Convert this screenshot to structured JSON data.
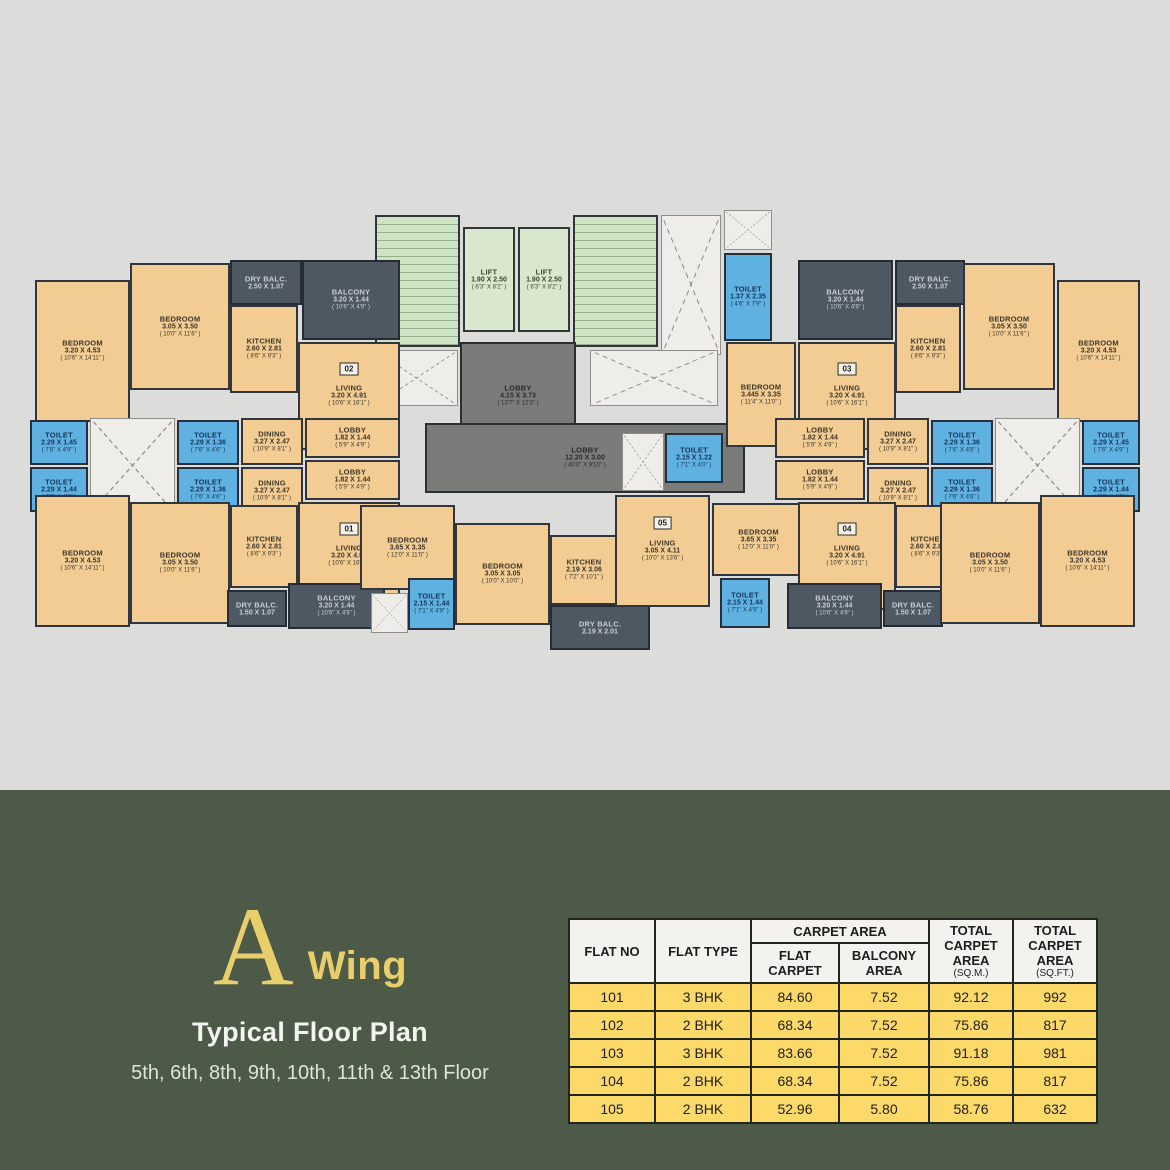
{
  "title": {
    "letter": "A",
    "word": "Wing",
    "subtitle": "Typical Floor Plan",
    "floors": "5th, 6th, 8th, 9th, 10th, 11th & 13th Floor"
  },
  "colors": {
    "gold": "#e8cf6c",
    "panel_green": "#4d5a47",
    "table_yellow": "#fcd968",
    "room_peach": "#f2cc92",
    "toilet_blue": "#5fb1e2",
    "stair_green": "#cfe3c5",
    "balcony_slate": "#4e5862",
    "lobby_gray": "#7b7b79",
    "wall_dark": "#30363c",
    "shaft_white": "#efedea",
    "bg_gray": "#dcdcda"
  },
  "table": {
    "headers": {
      "flat_no": "FLAT NO",
      "flat_type": "FLAT TYPE",
      "carpet_area": "CARPET AREA",
      "flat_carpet": "FLAT CARPET",
      "balcony_area": "BALCONY AREA",
      "total_sqm": {
        "main": "TOTAL CARPET AREA",
        "sub": "(SQ.M.)"
      },
      "total_sqft": {
        "main": "TOTAL CARPET AREA",
        "sub": "(SQ.FT.)"
      }
    },
    "rows": [
      [
        "101",
        "3 BHK",
        "84.60",
        "7.52",
        "92.12",
        "992"
      ],
      [
        "102",
        "2 BHK",
        "68.34",
        "7.52",
        "75.86",
        "817"
      ],
      [
        "103",
        "3 BHK",
        "83.66",
        "7.52",
        "91.18",
        "981"
      ],
      [
        "104",
        "2 BHK",
        "68.34",
        "7.52",
        "75.86",
        "817"
      ],
      [
        "105",
        "2 BHK",
        "52.96",
        "5.80",
        "58.76",
        "632"
      ]
    ]
  },
  "plan": {
    "rooms": [
      {
        "id": "stair-left",
        "type": "stair",
        "box": [
          345,
          10,
          85,
          132
        ]
      },
      {
        "id": "lift-1",
        "type": "lift",
        "box": [
          433,
          22,
          52,
          105
        ],
        "lines": [
          "LIFT",
          "1.90 X 2.50",
          "( 6'3\" X 8'2\" )"
        ]
      },
      {
        "id": "lift-2",
        "type": "lift",
        "box": [
          488,
          22,
          52,
          105
        ],
        "lines": [
          "LIFT",
          "1.90 X 2.50",
          "( 6'3\" X 8'2\" )"
        ]
      },
      {
        "id": "stair-right",
        "type": "stair",
        "box": [
          543,
          10,
          85,
          132
        ]
      },
      {
        "id": "shaft-core",
        "type": "shaft",
        "box": [
          631,
          10,
          60,
          140
        ]
      },
      {
        "id": "shaft-core-top",
        "type": "shaft",
        "box": [
          694,
          5,
          48,
          40
        ]
      },
      {
        "id": "toilet-core",
        "type": "toilet",
        "box": [
          694,
          48,
          48,
          88
        ],
        "lines": [
          "TOILET",
          "1.37 X 2.35",
          "( 4'6\" X 7'9\" )"
        ]
      },
      {
        "id": "lobby-upper",
        "type": "lobby",
        "box": [
          430,
          137,
          116,
          108
        ],
        "lines": [
          "LOBBY",
          "4.15 X 3.73",
          "( 13'7\" X 12'3\" )"
        ]
      },
      {
        "id": "shaft-left-core",
        "type": "shaft",
        "box": [
          345,
          145,
          83,
          56
        ]
      },
      {
        "id": "shaft-right-core",
        "type": "shaft",
        "box": [
          560,
          145,
          128,
          56
        ]
      },
      {
        "id": "lobby-main",
        "type": "lobby",
        "box": [
          395,
          218,
          320,
          70
        ],
        "lines": [
          "LOBBY",
          "12.20 X 3.00",
          "( 40'0\" X 9'10\" )"
        ]
      },
      {
        "id": "bedroom-02-a",
        "type": "room-fill",
        "box": [
          5,
          75,
          95,
          142
        ],
        "lines": [
          "BEDROOM",
          "3.20 X 4.53",
          "( 10'6\" X 14'11\" )"
        ]
      },
      {
        "id": "bedroom-02-b",
        "type": "room-fill",
        "box": [
          100,
          58,
          100,
          127
        ],
        "lines": [
          "BEDROOM",
          "3.05 X 3.50",
          "( 10'0\" X 11'6\" )"
        ]
      },
      {
        "id": "dry-balc-02",
        "type": "balcony",
        "box": [
          200,
          55,
          72,
          45
        ],
        "lines": [
          "DRY BALC.",
          "2.50 X 1.07"
        ]
      },
      {
        "id": "kitchen-02",
        "type": "room-fill",
        "box": [
          200,
          100,
          68,
          88
        ],
        "lines": [
          "KITCHEN",
          "2.60 X 2.81",
          "( 8'6\" X 9'3\" )"
        ]
      },
      {
        "id": "balcony-02",
        "type": "balcony",
        "box": [
          272,
          55,
          98,
          80
        ],
        "lines": [
          "BALCONY",
          "3.20 X 1.44",
          "( 10'6\" X 4'9\" )"
        ]
      },
      {
        "id": "living-02",
        "type": "room-fill",
        "box": [
          268,
          137,
          102,
          108
        ],
        "badge": "02",
        "lines": [
          "LIVING",
          "3.20 X 4.91",
          "( 10'6\" X 16'1\" )"
        ]
      },
      {
        "id": "toilet-02-1",
        "type": "toilet",
        "box": [
          0,
          215,
          58,
          45
        ],
        "lines": [
          "TOILET",
          "2.29 X 1.45",
          "( 7'6\" X 4'9\" )"
        ]
      },
      {
        "id": "toilet-01-1",
        "type": "toilet",
        "box": [
          0,
          262,
          58,
          45
        ],
        "lines": [
          "TOILET",
          "2.29 X 1.44",
          "( 7'6\" X 4'9\" )"
        ]
      },
      {
        "id": "shaft-left-wing",
        "type": "shaft",
        "box": [
          60,
          213,
          85,
          95
        ]
      },
      {
        "id": "toilet-02-2",
        "type": "toilet",
        "box": [
          147,
          215,
          62,
          45
        ],
        "lines": [
          "TOILET",
          "2.29 X 1.36",
          "( 7'6\" X 4'6\" )"
        ]
      },
      {
        "id": "toilet-01-2",
        "type": "toilet",
        "box": [
          147,
          262,
          62,
          45
        ],
        "lines": [
          "TOILET",
          "2.29 X 1.36",
          "( 7'6\" X 4'6\" )"
        ]
      },
      {
        "id": "dining-02",
        "type": "room-fill",
        "box": [
          211,
          213,
          62,
          47
        ],
        "lines": [
          "DINING",
          "3.27 X 2.47",
          "( 10'9\" X 8'1\" )"
        ]
      },
      {
        "id": "dining-01",
        "type": "room-fill",
        "box": [
          211,
          262,
          62,
          47
        ],
        "lines": [
          "DINING",
          "3.27 X 2.47",
          "( 10'9\" X 8'1\" )"
        ]
      },
      {
        "id": "lobby-02",
        "type": "room-fill",
        "box": [
          275,
          213,
          95,
          40
        ],
        "lines": [
          "LOBBY",
          "1.82 X 1.44",
          "( 5'9\" X 4'9\" )"
        ]
      },
      {
        "id": "lobby-01",
        "type": "room-fill",
        "box": [
          275,
          255,
          95,
          40
        ],
        "lines": [
          "LOBBY",
          "1.82 X 1.44",
          "( 5'9\" X 4'9\" )"
        ]
      },
      {
        "id": "living-01",
        "type": "room-fill",
        "box": [
          268,
          297,
          102,
          108
        ],
        "badge": "01",
        "lines": [
          "LIVING",
          "3.20 X 4.91",
          "( 10'6\" X 16'1\" )"
        ]
      },
      {
        "id": "bedroom-01-a",
        "type": "room-fill",
        "box": [
          5,
          290,
          95,
          132
        ],
        "lines": [
          "BEDROOM",
          "3.20 X 4.53",
          "( 10'6\" X 14'11\" )"
        ]
      },
      {
        "id": "bedroom-01-b",
        "type": "room-fill",
        "box": [
          100,
          297,
          100,
          122
        ],
        "lines": [
          "BEDROOM",
          "3.05 X 3.50",
          "( 10'0\" X 11'6\" )"
        ]
      },
      {
        "id": "kitchen-01",
        "type": "room-fill",
        "box": [
          200,
          300,
          68,
          83
        ],
        "lines": [
          "KITCHEN",
          "2.60 X 2.81",
          "( 8'6\" X 9'3\" )"
        ]
      },
      {
        "id": "dry-balc-01",
        "type": "balcony",
        "box": [
          197,
          385,
          60,
          37
        ],
        "lines": [
          "DRY BALC.",
          "1.50 X 1.07"
        ]
      },
      {
        "id": "balcony-01",
        "type": "balcony",
        "box": [
          258,
          378,
          97,
          46
        ],
        "lines": [
          "BALCONY",
          "3.20 X 1.44",
          "( 10'6\" X 4'9\" )"
        ]
      },
      {
        "id": "bedroom-01-c",
        "type": "room-fill",
        "box": [
          330,
          300,
          95,
          85
        ],
        "lines": [
          "BEDROOM",
          "3.65 X 3.35",
          "( 12'0\" X 11'0\" )"
        ]
      },
      {
        "id": "shaft-05-left",
        "type": "shaft",
        "box": [
          341,
          388,
          37,
          40
        ]
      },
      {
        "id": "toilet-05-a",
        "type": "toilet",
        "box": [
          378,
          373,
          47,
          52
        ],
        "lines": [
          "TOILET",
          "2.15 X 1.44",
          "( 7'1\" X 4'9\" )"
        ]
      },
      {
        "id": "bedroom-05",
        "type": "room-fill",
        "box": [
          425,
          318,
          95,
          102
        ],
        "lines": [
          "BEDROOM",
          "3.05 X 3.05",
          "( 10'0\" X 10'0\" )"
        ]
      },
      {
        "id": "shaft-05-top",
        "type": "shaft",
        "box": [
          592,
          228,
          42,
          58
        ]
      },
      {
        "id": "toilet-05-b",
        "type": "toilet",
        "box": [
          635,
          228,
          58,
          50
        ],
        "lines": [
          "TOILET",
          "2.15 X 1.22",
          "( 7'1\" X 4'0\" )"
        ]
      },
      {
        "id": "kitchen-05",
        "type": "room-fill",
        "box": [
          520,
          330,
          68,
          70
        ],
        "lines": [
          "KITCHEN",
          "2.19 X 3.06",
          "( 7'2\" X 10'1\" )"
        ]
      },
      {
        "id": "dry-balc-05",
        "type": "balcony",
        "box": [
          520,
          400,
          100,
          45
        ],
        "lines": [
          "DRY BALC.",
          "2.19 X 2.01"
        ]
      },
      {
        "id": "living-05",
        "type": "room-fill",
        "box": [
          585,
          290,
          95,
          112
        ],
        "badge": "05",
        "lines": [
          "LIVING",
          "3.05 X 4.11",
          "( 10'0\" X 13'6\" )"
        ]
      },
      {
        "id": "bedroom-04-c",
        "type": "room-fill",
        "box": [
          682,
          298,
          93,
          73
        ],
        "lines": [
          "BEDROOM",
          "3.65 X 3.35",
          "( 12'0\" X 11'0\" )"
        ]
      },
      {
        "id": "toilet-04-a",
        "type": "toilet",
        "box": [
          690,
          373,
          50,
          50
        ],
        "lines": [
          "TOILET",
          "2.15 X 1.44",
          "( 7'1\" X 4'9\" )"
        ]
      },
      {
        "id": "bedroom-03-c",
        "type": "room-fill",
        "box": [
          696,
          137,
          70,
          105
        ],
        "lines": [
          "BEDROOM",
          "3.445 X 3.35",
          "( 11'4\" X 11'0\" )"
        ]
      },
      {
        "id": "balcony-03",
        "type": "balcony",
        "box": [
          768,
          55,
          95,
          80
        ],
        "lines": [
          "BALCONY",
          "3.20 X 1.44",
          "( 10'6\" X 4'9\" )"
        ]
      },
      {
        "id": "living-03",
        "type": "room-fill",
        "box": [
          768,
          137,
          98,
          108
        ],
        "badge": "03",
        "lines": [
          "LIVING",
          "3.20 X 4.91",
          "( 10'6\" X 16'1\" )"
        ]
      },
      {
        "id": "dry-balc-03",
        "type": "balcony",
        "box": [
          865,
          55,
          70,
          45
        ],
        "lines": [
          "DRY BALC.",
          "2.50 X 1.07"
        ]
      },
      {
        "id": "kitchen-03",
        "type": "room-fill",
        "box": [
          865,
          100,
          66,
          88
        ],
        "lines": [
          "KITCHEN",
          "2.60 X 2.81",
          "( 8'6\" X 9'3\" )"
        ]
      },
      {
        "id": "bedroom-03-b",
        "type": "room-fill",
        "box": [
          933,
          58,
          92,
          127
        ],
        "lines": [
          "BEDROOM",
          "3.05 X 3.50",
          "( 10'0\" X 11'6\" )"
        ]
      },
      {
        "id": "bedroom-03-a",
        "type": "room-fill",
        "box": [
          1027,
          75,
          83,
          142
        ],
        "lines": [
          "BEDROOM",
          "3.20 X 4.53",
          "( 10'6\" X 14'11\" )"
        ]
      },
      {
        "id": "lobby-03",
        "type": "room-fill",
        "box": [
          745,
          213,
          90,
          40
        ],
        "lines": [
          "LOBBY",
          "1.82 X 1.44",
          "( 5'9\" X 4'9\" )"
        ]
      },
      {
        "id": "lobby-04",
        "type": "room-fill",
        "box": [
          745,
          255,
          90,
          40
        ],
        "lines": [
          "LOBBY",
          "1.82 X 1.44",
          "( 5'9\" X 4'9\" )"
        ]
      },
      {
        "id": "dining-03",
        "type": "room-fill",
        "box": [
          837,
          213,
          62,
          47
        ],
        "lines": [
          "DINING",
          "3.27 X 2.47",
          "( 10'9\" X 8'1\" )"
        ]
      },
      {
        "id": "dining-04",
        "type": "room-fill",
        "box": [
          837,
          262,
          62,
          47
        ],
        "lines": [
          "DINING",
          "3.27 X 2.47",
          "( 10'9\" X 8'1\" )"
        ]
      },
      {
        "id": "toilet-03-2",
        "type": "toilet",
        "box": [
          901,
          215,
          62,
          45
        ],
        "lines": [
          "TOILET",
          "2.29 X 1.36",
          "( 7'6\" X 4'6\" )"
        ]
      },
      {
        "id": "toilet-04-2",
        "type": "toilet",
        "box": [
          901,
          262,
          62,
          45
        ],
        "lines": [
          "TOILET",
          "2.29 X 1.36",
          "( 7'6\" X 4'6\" )"
        ]
      },
      {
        "id": "shaft-right-wing",
        "type": "shaft",
        "box": [
          965,
          213,
          85,
          95
        ]
      },
      {
        "id": "toilet-03-1",
        "type": "toilet",
        "box": [
          1052,
          215,
          58,
          45
        ],
        "lines": [
          "TOILET",
          "2.29 X 1.45",
          "( 7'6\" X 4'9\" )"
        ]
      },
      {
        "id": "toilet-04-1",
        "type": "toilet",
        "box": [
          1052,
          262,
          58,
          45
        ],
        "lines": [
          "TOILET",
          "2.29 X 1.44",
          "( 7'6\" X 4'9\" )"
        ]
      },
      {
        "id": "living-04",
        "type": "room-fill",
        "box": [
          768,
          297,
          98,
          108
        ],
        "badge": "04",
        "lines": [
          "LIVING",
          "3.20 X 4.91",
          "( 10'6\" X 16'1\" )"
        ]
      },
      {
        "id": "kitchen-04",
        "type": "room-fill",
        "box": [
          865,
          300,
          66,
          83
        ],
        "lines": [
          "KITCHEN",
          "2.60 X 2.81",
          "( 8'6\" X 9'3\" )"
        ]
      },
      {
        "id": "dry-balc-04",
        "type": "balcony",
        "box": [
          853,
          385,
          60,
          37
        ],
        "lines": [
          "DRY BALC.",
          "1.50 X 1.07"
        ]
      },
      {
        "id": "balcony-04",
        "type": "balcony",
        "box": [
          757,
          378,
          95,
          46
        ],
        "lines": [
          "BALCONY",
          "3.20 X 1.44",
          "( 10'6\" X 4'9\" )"
        ]
      },
      {
        "id": "bedroom-04-b",
        "type": "room-fill",
        "box": [
          910,
          297,
          100,
          122
        ],
        "lines": [
          "BEDROOM",
          "3.05 X 3.50",
          "( 10'0\" X 11'6\" )"
        ]
      },
      {
        "id": "bedroom-04-a",
        "type": "room-fill",
        "box": [
          1010,
          290,
          95,
          132
        ],
        "lines": [
          "BEDROOM",
          "3.20 X 4.53",
          "( 10'6\" X 14'11\" )"
        ]
      }
    ]
  }
}
